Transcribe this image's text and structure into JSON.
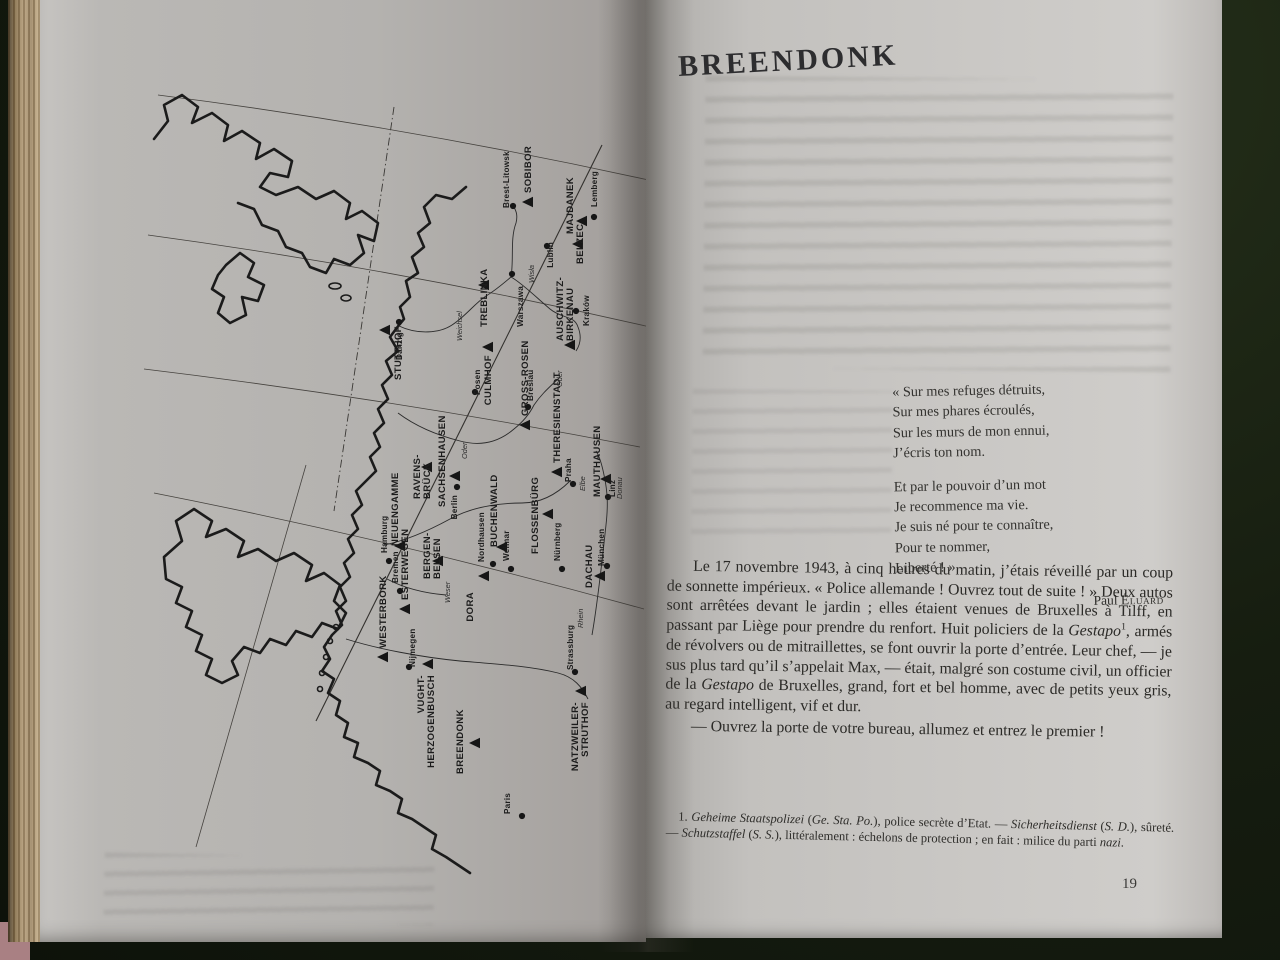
{
  "left_page": {
    "map": {
      "camps": [
        {
          "name": "STUTTHOF",
          "x": 255,
          "y": 251,
          "dx": 16,
          "dy": 50
        },
        {
          "name": "SOBIBOR",
          "x": 398,
          "y": 123
        },
        {
          "name": "MAJDANEK",
          "x": 452,
          "y": 142,
          "dx": -9,
          "dy": 13
        },
        {
          "name": "BELZEC",
          "x": 448,
          "y": 165,
          "dx": 5,
          "dy": 20
        },
        {
          "name": "TREBLINKA",
          "x": 354,
          "y": 206,
          "dx": 3,
          "dy": 42
        },
        {
          "name": "AUSCHWITZ-",
          "line2": "BIRKENAU",
          "x": 440,
          "y": 266,
          "dx": -7,
          "dy": -4
        },
        {
          "name": "CULMHOF",
          "x": 358,
          "y": 268,
          "dir": "down",
          "dx": 3,
          "dy": 8
        },
        {
          "name": "GROSS-ROSEN",
          "x": 395,
          "y": 346
        },
        {
          "name": "THERESIENSTADT",
          "x": 427,
          "y": 393
        },
        {
          "name": "FLOSSENBÜRG",
          "x": 418,
          "y": 435,
          "dx": -10,
          "dy": 40
        },
        {
          "name": "DACHAU",
          "x": 470,
          "y": 497,
          "dx": -8,
          "dy": 12
        },
        {
          "name": "MAUTHAUSEN",
          "x": 476,
          "y": 400,
          "dx": -6,
          "dy": 18
        },
        {
          "name": "SACHSENHAUSEN",
          "x": 325,
          "y": 397,
          "dx": -10,
          "dy": 31
        },
        {
          "name": "RAVENS-",
          "line2": "BRÜCK",
          "x": 297,
          "y": 388,
          "dx": -7,
          "dy": 32
        },
        {
          "name": "NEUENGAMME",
          "x": 270,
          "y": 467,
          "dx": -2,
          "dy": 0
        },
        {
          "name": "BERGEN-",
          "line2": "BELSEN",
          "x": 308,
          "y": 482,
          "dx": -8,
          "dy": 18
        },
        {
          "name": "WESTERBORK",
          "x": 253,
          "y": 578
        },
        {
          "name": "ESTERWEGEN",
          "x": 275,
          "y": 530
        },
        {
          "name": "VUGHT-",
          "line2": "HERZOGENBUSCH",
          "x": 298,
          "y": 585,
          "dir": "down",
          "dx": -4,
          "dy": 11
        },
        {
          "name": "DORA",
          "x": 354,
          "y": 497,
          "dir": "down",
          "dx": -11,
          "dy": 16
        },
        {
          "name": "BUCHENWALD",
          "x": 372,
          "y": 468,
          "dx": -5,
          "dy": 0
        },
        {
          "name": "BREENDONK",
          "x": 345,
          "y": 664,
          "dx": -12,
          "dy": 31
        },
        {
          "name": "NATZWEILER-",
          "line2": "STRUTHOF",
          "x": 451,
          "y": 612,
          "dir": "down",
          "dx": -3,
          "dy": 11
        }
      ],
      "cities": [
        {
          "name": "Brest-Litowsk",
          "x": 383,
          "y": 127,
          "dx": -4,
          "dy": 2
        },
        {
          "name": "Lemberg",
          "x": 464,
          "y": 138,
          "dx": 3,
          "dy": -10
        },
        {
          "name": "Lublin",
          "x": 417,
          "y": 167,
          "dir": "down",
          "dx": 6,
          "dy": -4
        },
        {
          "name": "Warszawa",
          "x": 382,
          "y": 195,
          "dir": "down",
          "dx": 11,
          "dy": 12
        },
        {
          "name": "Kraków",
          "x": 446,
          "y": 232,
          "dx": 13,
          "dy": 15
        },
        {
          "name": "Danzig",
          "x": 269,
          "y": 243,
          "dir": "down",
          "dx": 3,
          "dy": 10
        },
        {
          "name": "Posen",
          "x": 345,
          "y": 313,
          "dx": 5,
          "dy": 3
        },
        {
          "name": "Breslau",
          "x": 398,
          "y": 328,
          "dx": 5,
          "dy": -6
        },
        {
          "name": "Praha",
          "x": 443,
          "y": 405,
          "dx": -2,
          "dy": -2
        },
        {
          "name": "Berlin",
          "x": 327,
          "y": 408,
          "dir": "down",
          "dx": 0,
          "dy": 8
        },
        {
          "name": "Hamburg",
          "x": 259,
          "y": 482
        },
        {
          "name": "Bremen",
          "x": 270,
          "y": 512
        },
        {
          "name": "Nijmegen",
          "x": 279,
          "y": 588,
          "dx": 6,
          "dy": 0
        },
        {
          "name": "Nordhausen",
          "x": 363,
          "y": 485,
          "dx": -9,
          "dy": -2
        },
        {
          "name": "Weimar",
          "x": 381,
          "y": 490
        },
        {
          "name": "Nürnberg",
          "x": 432,
          "y": 490
        },
        {
          "name": "München",
          "x": 477,
          "y": 487,
          "dx": -3,
          "dy": 0
        },
        {
          "name": "Linz",
          "x": 478,
          "y": 418,
          "dx": 7,
          "dy": 0
        },
        {
          "name": "Strassburg",
          "x": 445,
          "y": 593,
          "dx": -2,
          "dy": -2
        },
        {
          "name": "Paris",
          "x": 392,
          "y": 737,
          "dx": -12,
          "dy": -2
        }
      ],
      "rivers": [
        {
          "name": "Weichsel",
          "x": 332,
          "y": 262
        },
        {
          "name": "Wisła",
          "x": 404,
          "y": 204
        },
        {
          "name": "Oder",
          "x": 337,
          "y": 380
        },
        {
          "name": "Oder",
          "x": 432,
          "y": 308
        },
        {
          "name": "Elbe",
          "x": 455,
          "y": 412
        },
        {
          "name": "Weser",
          "x": 320,
          "y": 524
        },
        {
          "name": "Rhein",
          "x": 453,
          "y": 549
        },
        {
          "name": "Donau",
          "x": 492,
          "y": 420
        }
      ]
    }
  },
  "right_page": {
    "title": "BREENDONK",
    "poem": {
      "stanza1": [
        "« Sur mes refuges détruits,",
        "Sur mes phares écroulés,",
        "Sur les murs de mon ennui,",
        "J’écris ton nom."
      ],
      "stanza2": [
        "Et par le pouvoir d’un mot",
        "Je recommence ma vie.",
        "Je suis né pour te connaître,",
        "Pour te nommer,",
        "Liberté ! »"
      ],
      "attr_first": "Paul ",
      "attr_name": "Éluard"
    },
    "paragraph1": {
      "a": "Le 17 novembre 1943, à cinq heures du matin, j’étais réveillé par un coup de sonnette impérieux. « Police allemande ! Ouvrez tout de suite ! » Deux autos sont arrêtées devant le jardin ; elles étaient venues de Bruxelles à Tilff, en passant par Liège pour prendre du renfort. Huit policiers de la ",
      "it1": "Gestapo",
      "ref": "1",
      "b": ", armés de révolvers ou de mitraillettes, se font ouvrir la porte d’entrée. Leur chef, — je sus plus tard qu’il s’appelait Max, — était, malgré son costume civil, un officier de la ",
      "it2": "Gestapo",
      "c": " de Bruxelles, grand, fort et bel homme, avec de petits yeux gris, au regard intelligent, vif et dur."
    },
    "paragraph2": "— Ouvrez la porte de votre bureau, allumez et entrez le premier !",
    "footnote": {
      "n1": "1. ",
      "i1": "Geheime Staatspolizei",
      "n2": " (",
      "i2": "Ge. Sta. Po.",
      "n3": "), police secrète d’Etat. — ",
      "i3": "Sicherheitsdienst",
      "n4": " (",
      "i4": "S. D.",
      "n5": "), sûreté. — ",
      "i5": "Schutzstaffel",
      "n6": " (",
      "i6": "S. S.",
      "n7": "), littéralement : échelons de protection ; en fait : milice du parti ",
      "i7": "nazi",
      "n8": "."
    },
    "page_number": "19"
  }
}
